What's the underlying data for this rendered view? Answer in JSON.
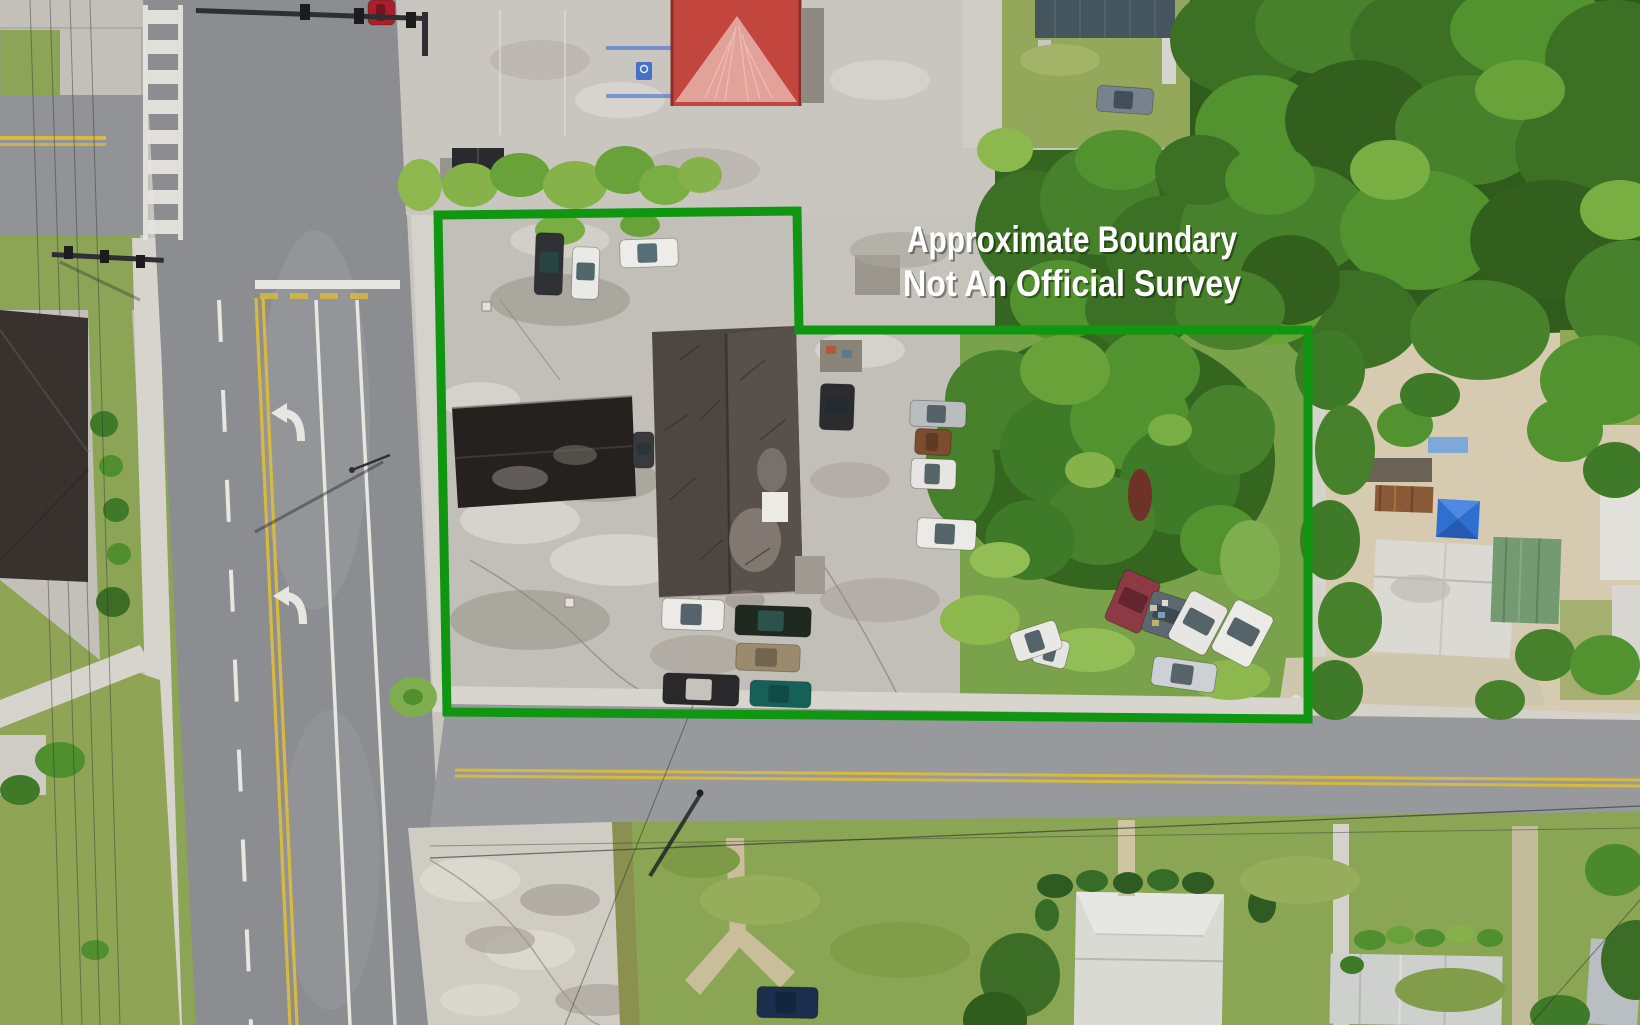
{
  "annotation": {
    "line1": "Approximate Boundary",
    "line2": "Not An Official Survey",
    "text_color": "#ffffff",
    "shadow_color": "rgba(0,0,0,0.38)"
  },
  "boundary": {
    "points": "438,215 797,211 799,330 1308,330 1308,719 447,712",
    "color": "#109611",
    "stroke_width": 9
  },
  "scene": {
    "palette": {
      "asphalt": "#8b8d90",
      "asphalt_cross": "#97999c",
      "concrete": "#c9c6c0",
      "worn_concrete": "#bdbab3",
      "sidewalk": "#d7d4cd",
      "grass_lawn": "#8aa553",
      "grass_overgrown": "#7aa24a",
      "sand": "#d6cbb0",
      "forest_dark": "#2f5c1c",
      "roof_main_dark": "#4e4741",
      "roof_black_wing": "#24211f",
      "roof_red": "#c2463e",
      "roof_gable_pink": "#e2a29a",
      "roof_white_metal": "#dadad5",
      "roof_green_metal": "#739a70",
      "roof_blue_gray": "#45555e",
      "canopy_blue": "#2f6fd0",
      "line_yellow": "#d8b93f",
      "line_white": "#e8e6e1"
    },
    "vehicles": [
      {
        "x": 535,
        "y": 233,
        "w": 28,
        "h": 62,
        "r": 2,
        "body": "#2f3134",
        "glass": "#274742"
      },
      {
        "x": 572,
        "y": 247,
        "w": 27,
        "h": 52,
        "r": 2,
        "body": "#e9e9e6",
        "glass": "#3e5a5e"
      },
      {
        "x": 620,
        "y": 239,
        "w": 58,
        "h": 28,
        "r": -2,
        "body": "#edece8",
        "glass": "#44606a"
      },
      {
        "x": 368,
        "y": 0,
        "w": 27,
        "h": 25,
        "r": 0,
        "body": "#ab1f2d",
        "glass": "#6b1420"
      },
      {
        "x": 1097,
        "y": 87,
        "w": 56,
        "h": 26,
        "r": 4,
        "body": "#76838f",
        "glass": "#3c4852"
      },
      {
        "x": 820,
        "y": 384,
        "w": 34,
        "h": 46,
        "r": 2,
        "body": "#2c2c2f",
        "glass": "#1f2c30"
      },
      {
        "x": 910,
        "y": 401,
        "w": 56,
        "h": 26,
        "r": 2,
        "body": "#b9bdc0",
        "glass": "#4a585e"
      },
      {
        "x": 915,
        "y": 429,
        "w": 36,
        "h": 26,
        "r": 3,
        "body": "#7d4b2e",
        "glass": "#5a3a24"
      },
      {
        "x": 911,
        "y": 459,
        "w": 45,
        "h": 30,
        "r": 2,
        "body": "#e6e5e1",
        "glass": "#46565c"
      },
      {
        "x": 917,
        "y": 519,
        "w": 59,
        "h": 30,
        "r": 3,
        "body": "#eceae6",
        "glass": "#46565c"
      },
      {
        "x": 633,
        "y": 432,
        "w": 21,
        "h": 36,
        "r": 0,
        "body": "#3a3a3c",
        "glass": "#2a3438"
      },
      {
        "x": 662,
        "y": 599,
        "w": 62,
        "h": 31,
        "r": 2,
        "body": "#ebeae6",
        "glass": "#45555c"
      },
      {
        "x": 735,
        "y": 606,
        "w": 76,
        "h": 30,
        "r": 2,
        "body": "#20291f",
        "glass": "#2e5650"
      },
      {
        "x": 736,
        "y": 644,
        "w": 64,
        "h": 27,
        "r": 2,
        "body": "#9b8a6c",
        "glass": "#6e614b"
      },
      {
        "x": 663,
        "y": 674,
        "w": 76,
        "h": 31,
        "r": 2,
        "body": "#29292b",
        "glass": "#d8d4cc"
      },
      {
        "x": 750,
        "y": 681,
        "w": 61,
        "h": 26,
        "r": 2,
        "body": "#176058",
        "glass": "#0f4a44"
      },
      {
        "x": 1113,
        "y": 574,
        "w": 39,
        "h": 55,
        "r": 24,
        "body": "#8e3a44",
        "glass": "#5e242f"
      },
      {
        "x": 1146,
        "y": 595,
        "w": 41,
        "h": 42,
        "r": 18,
        "body": "#5b6870",
        "glass": "#3b464c"
      },
      {
        "x": 1177,
        "y": 596,
        "w": 42,
        "h": 54,
        "r": 28,
        "body": "#e7e6e2",
        "glass": "#45555c"
      },
      {
        "x": 1221,
        "y": 605,
        "w": 43,
        "h": 57,
        "r": 28,
        "body": "#eceae6",
        "glass": "#45555c"
      },
      {
        "x": 1152,
        "y": 660,
        "w": 64,
        "h": 29,
        "r": 8,
        "body": "#cdd1d4",
        "glass": "#4a585e"
      },
      {
        "x": 1034,
        "y": 638,
        "w": 34,
        "h": 28,
        "r": 14,
        "body": "#e4e4e0",
        "glass": "#45555c"
      },
      {
        "x": 757,
        "y": 987,
        "w": 61,
        "h": 31,
        "r": 1,
        "body": "#1c2e4d",
        "glass": "#14263e"
      },
      {
        "x": 1012,
        "y": 626,
        "w": 48,
        "h": 30,
        "r": -18,
        "body": "#e9e8e4",
        "glass": "#45555c"
      }
    ],
    "trees": [
      [
        1240,
        40,
        70,
        55,
        "#3c7024"
      ],
      [
        1330,
        25,
        75,
        50,
        "#48812b"
      ],
      [
        1430,
        40,
        80,
        55,
        "#3c7024"
      ],
      [
        1530,
        30,
        80,
        50,
        "#52922f"
      ],
      [
        1615,
        60,
        70,
        60,
        "#3c7024"
      ],
      [
        1260,
        130,
        65,
        55,
        "#52922f"
      ],
      [
        1360,
        120,
        75,
        60,
        "#335f1e"
      ],
      [
        1470,
        130,
        75,
        55,
        "#48812b"
      ],
      [
        1590,
        150,
        75,
        60,
        "#3c7024"
      ],
      [
        1300,
        220,
        70,
        55,
        "#48812b"
      ],
      [
        1420,
        230,
        80,
        60,
        "#52922f"
      ],
      [
        1550,
        240,
        80,
        60,
        "#335f1e"
      ],
      [
        1630,
        300,
        65,
        60,
        "#48812b"
      ],
      [
        1350,
        320,
        70,
        50,
        "#3c7024"
      ],
      [
        1480,
        330,
        70,
        50,
        "#48812b"
      ],
      [
        1600,
        380,
        60,
        45,
        "#52922f"
      ],
      [
        1270,
        300,
        55,
        45,
        "#6aa23a"
      ],
      [
        1390,
        170,
        40,
        30,
        "#79ae42"
      ],
      [
        1520,
        90,
        45,
        30,
        "#6aa23a"
      ],
      [
        1620,
        210,
        40,
        30,
        "#79ae42"
      ],
      [
        1030,
        230,
        55,
        60,
        "#3c7024"
      ],
      [
        1100,
        200,
        60,
        55,
        "#48812b"
      ],
      [
        1170,
        250,
        65,
        55,
        "#3c7024"
      ],
      [
        1240,
        230,
        60,
        55,
        "#48812b"
      ],
      [
        1290,
        280,
        50,
        45,
        "#335f1e"
      ],
      [
        1060,
        300,
        50,
        40,
        "#52922f"
      ],
      [
        1140,
        310,
        55,
        40,
        "#3c7024"
      ],
      [
        1230,
        310,
        55,
        40,
        "#48812b"
      ],
      [
        1005,
        150,
        28,
        22,
        "#8cb84e"
      ],
      [
        1120,
        160,
        45,
        30,
        "#52922f"
      ],
      [
        1200,
        170,
        45,
        35,
        "#3c7024"
      ],
      [
        1270,
        180,
        45,
        35,
        "#52922f"
      ],
      [
        1000,
        400,
        55,
        50,
        "#48812b"
      ],
      [
        1060,
        450,
        60,
        55,
        "#3f7a28"
      ],
      [
        1130,
        420,
        60,
        50,
        "#52922f"
      ],
      [
        1180,
        480,
        60,
        55,
        "#3f7a28"
      ],
      [
        1100,
        520,
        55,
        45,
        "#48812b"
      ],
      [
        1030,
        540,
        45,
        40,
        "#3f7a28"
      ],
      [
        1230,
        430,
        45,
        45,
        "#48812b"
      ],
      [
        1150,
        370,
        50,
        40,
        "#52922f"
      ],
      [
        1065,
        370,
        45,
        35,
        "#6aa23a"
      ],
      [
        1220,
        540,
        40,
        35,
        "#52922f"
      ],
      [
        1250,
        560,
        30,
        40,
        "#7fae4e"
      ],
      [
        960,
        470,
        35,
        55,
        "#48812b"
      ],
      [
        1090,
        470,
        25,
        18,
        "#86b24a"
      ],
      [
        1170,
        430,
        22,
        16,
        "#79ae42"
      ],
      [
        470,
        185,
        28,
        22,
        "#86b24a"
      ],
      [
        520,
        175,
        30,
        22,
        "#6aa23a"
      ],
      [
        575,
        185,
        32,
        24,
        "#86b24a"
      ],
      [
        625,
        170,
        30,
        24,
        "#6aa23a"
      ],
      [
        665,
        185,
        26,
        20,
        "#79ae42"
      ],
      [
        700,
        175,
        22,
        18,
        "#86b24a"
      ],
      [
        420,
        185,
        22,
        26,
        "#8cb84e"
      ],
      [
        560,
        230,
        25,
        15,
        "#79ae42"
      ],
      [
        640,
        225,
        20,
        12,
        "#6aa23a"
      ],
      [
        1330,
        370,
        35,
        40,
        "#3f7a28"
      ],
      [
        1345,
        450,
        30,
        45,
        "#48812b"
      ],
      [
        1330,
        540,
        30,
        40,
        "#3f7a28"
      ],
      [
        1350,
        620,
        32,
        38,
        "#48812b"
      ],
      [
        1335,
        690,
        28,
        30,
        "#3f7a28"
      ],
      [
        1565,
        430,
        38,
        32,
        "#52922f"
      ],
      [
        1615,
        470,
        32,
        28,
        "#3f7a28"
      ],
      [
        1545,
        655,
        30,
        26,
        "#48812b"
      ],
      [
        1605,
        665,
        35,
        30,
        "#52922f"
      ],
      [
        1500,
        700,
        25,
        20,
        "#48812b"
      ],
      [
        1405,
        425,
        28,
        22,
        "#52922f"
      ],
      [
        1430,
        395,
        30,
        22,
        "#3f7a28"
      ],
      [
        1020,
        975,
        40,
        42,
        "#3b6d26"
      ],
      [
        995,
        1020,
        32,
        28,
        "#2f5c1c"
      ],
      [
        1615,
        870,
        30,
        26,
        "#4a8a2c"
      ],
      [
        1636,
        960,
        35,
        40,
        "#3b6d26"
      ],
      [
        1560,
        1015,
        30,
        20,
        "#3f7a28"
      ],
      [
        60,
        760,
        25,
        18,
        "#4f8f2e"
      ],
      [
        20,
        790,
        20,
        15,
        "#3f7a28"
      ],
      [
        95,
        950,
        14,
        10,
        "#4f8f2e"
      ],
      [
        104,
        424,
        14,
        13,
        "#3f7a28"
      ],
      [
        111,
        466,
        12,
        11,
        "#4f8f2e"
      ],
      [
        116,
        510,
        13,
        12,
        "#3f7a28"
      ],
      [
        119,
        554,
        12,
        11,
        "#4f8f2e"
      ],
      [
        113,
        602,
        17,
        15,
        "#3b6d26"
      ],
      [
        1055,
        886,
        18,
        12,
        "#2e5b22"
      ],
      [
        1092,
        881,
        16,
        11,
        "#376b28"
      ],
      [
        1128,
        883,
        15,
        11,
        "#2e5b22"
      ],
      [
        1163,
        880,
        16,
        11,
        "#376b28"
      ],
      [
        1198,
        883,
        16,
        11,
        "#2e5b22"
      ],
      [
        1262,
        905,
        14,
        18,
        "#2e5b22"
      ],
      [
        1047,
        915,
        12,
        16,
        "#376b28"
      ],
      [
        1370,
        940,
        16,
        10,
        "#4f8f2e"
      ],
      [
        1400,
        935,
        14,
        9,
        "#6aa23a"
      ],
      [
        1430,
        938,
        15,
        9,
        "#4f8f2e"
      ],
      [
        1460,
        934,
        14,
        9,
        "#86b24a"
      ],
      [
        1490,
        938,
        13,
        9,
        "#4f8f2e"
      ],
      [
        1352,
        965,
        12,
        9,
        "#3f7a28"
      ],
      [
        413,
        697,
        24,
        20,
        "#7fae4e"
      ],
      [
        413,
        697,
        10,
        8,
        "#4f8f2e"
      ],
      [
        980,
        620,
        40,
        25,
        "#8cb84e"
      ],
      [
        1090,
        650,
        45,
        22,
        "#93bd55"
      ],
      [
        1230,
        680,
        40,
        20,
        "#8cb84e"
      ],
      [
        1000,
        560,
        30,
        18,
        "#93bd55"
      ],
      [
        760,
        900,
        60,
        25,
        "#96ad5b"
      ],
      [
        900,
        950,
        70,
        28,
        "#819d49"
      ],
      [
        1300,
        880,
        60,
        24,
        "#96ad5b"
      ],
      [
        1450,
        990,
        55,
        22,
        "#819d49"
      ],
      [
        700,
        860,
        40,
        18,
        "#7d9a47"
      ],
      [
        1060,
        60,
        40,
        16,
        "#a3b468"
      ]
    ]
  }
}
